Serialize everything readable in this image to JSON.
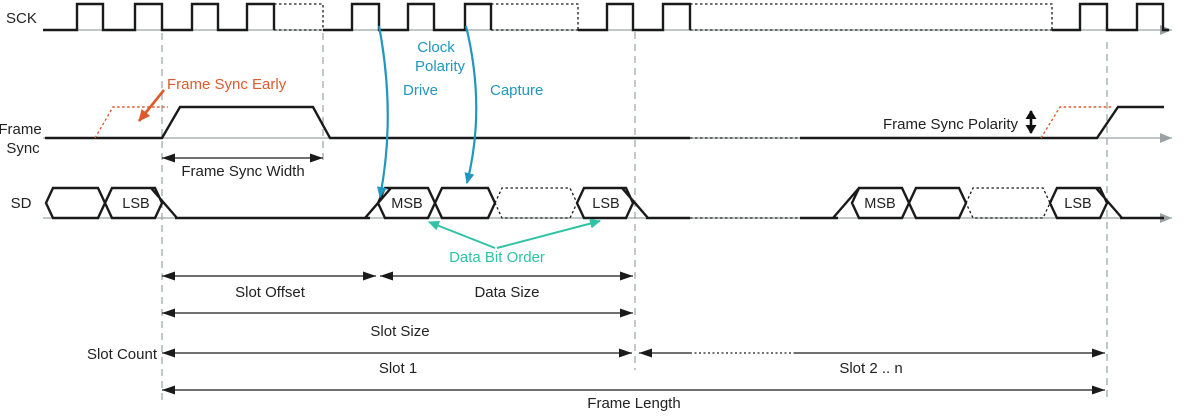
{
  "signals": {
    "sck": "SCK",
    "frame_sync_line1": "Frame",
    "frame_sync_line2": "Sync",
    "sd": "SD"
  },
  "annotations": {
    "frame_sync_early": "Frame Sync Early",
    "clock_polarity_line1": "Clock",
    "clock_polarity_line2": "Polarity",
    "drive": "Drive",
    "capture": "Capture",
    "frame_sync_width": "Frame Sync Width",
    "frame_sync_polarity": "Frame Sync Polarity",
    "data_bit_order": "Data Bit Order"
  },
  "dimensions": {
    "slot_offset": "Slot Offset",
    "data_size": "Data Size",
    "slot_size": "Slot Size",
    "slot_count": "Slot Count",
    "slot_1": "Slot 1",
    "slot_2_n": "Slot 2 .. n",
    "frame_length": "Frame Length"
  },
  "sd_cells": {
    "slot0_lsb": "LSB",
    "slot1_msb": "MSB",
    "slot1_lsb": "LSB",
    "slot2_msb": "MSB",
    "slot2_lsb": "LSB"
  },
  "colors": {
    "signal_black": "#1a1a1a",
    "axis_gray": "#9aa3a3",
    "accent_orange": "#DB5B2E",
    "accent_blue": "#2196BE",
    "accent_teal": "#2EC3A5"
  }
}
